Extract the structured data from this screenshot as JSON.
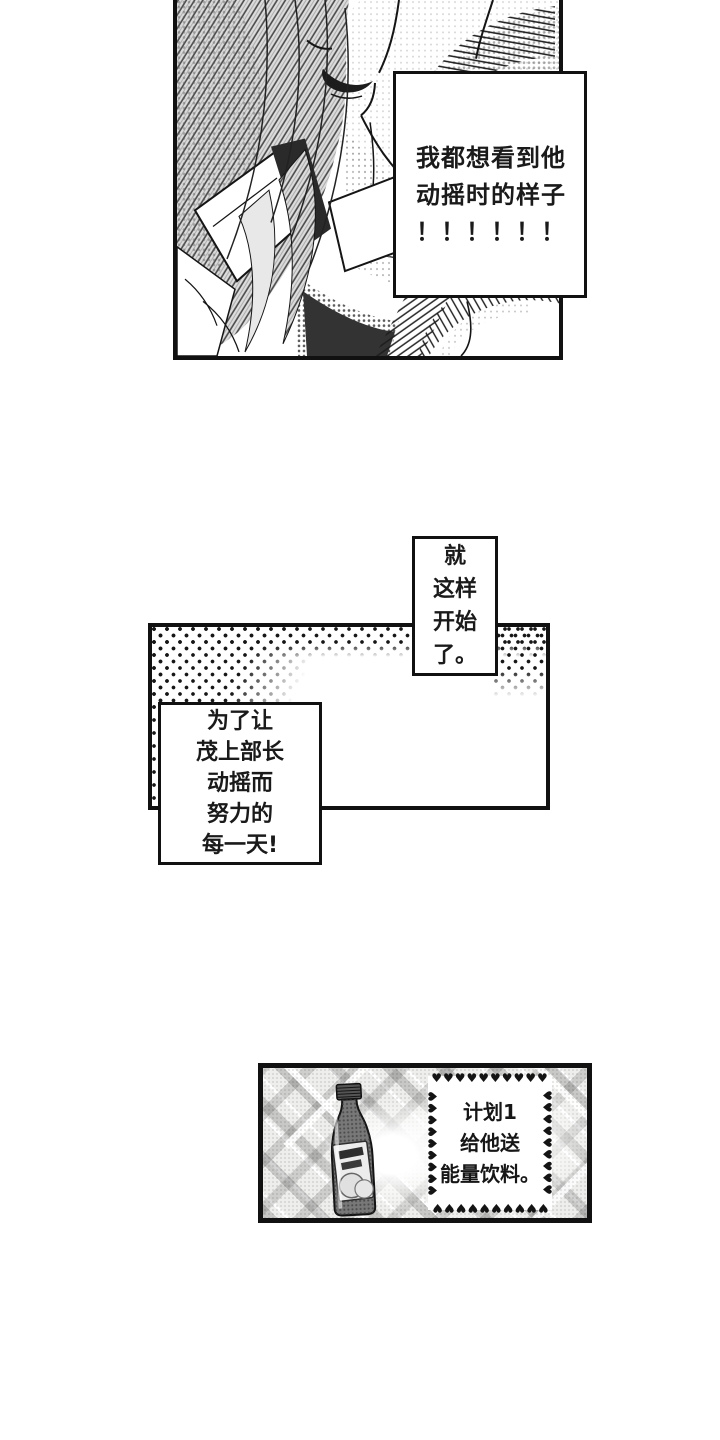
{
  "meta": {
    "kind": "manga-comic-page",
    "language": "zh"
  },
  "colors": {
    "ink": "#111111",
    "paper": "#ffffff"
  },
  "panel1": {
    "speech": {
      "lines": [
        "我都想看到他",
        "动摇时的样子",
        "！！！！！！"
      ]
    }
  },
  "panel2": {
    "vertical_caption": {
      "lines": [
        "就",
        "这样",
        "开始",
        "了。"
      ]
    },
    "effort_caption": {
      "lines": [
        "为了让",
        "茂上部长",
        "动摇而",
        "努力的",
        "每一天!"
      ]
    }
  },
  "panel3": {
    "plan_caption": {
      "lines": [
        "计划1",
        "给他送",
        "能量饮料。"
      ]
    },
    "hearts_row": "♥♥♥♥♥♥♥♥♥♥",
    "hearts_col": "♥♥♥♥♥♥♥♥♥"
  }
}
